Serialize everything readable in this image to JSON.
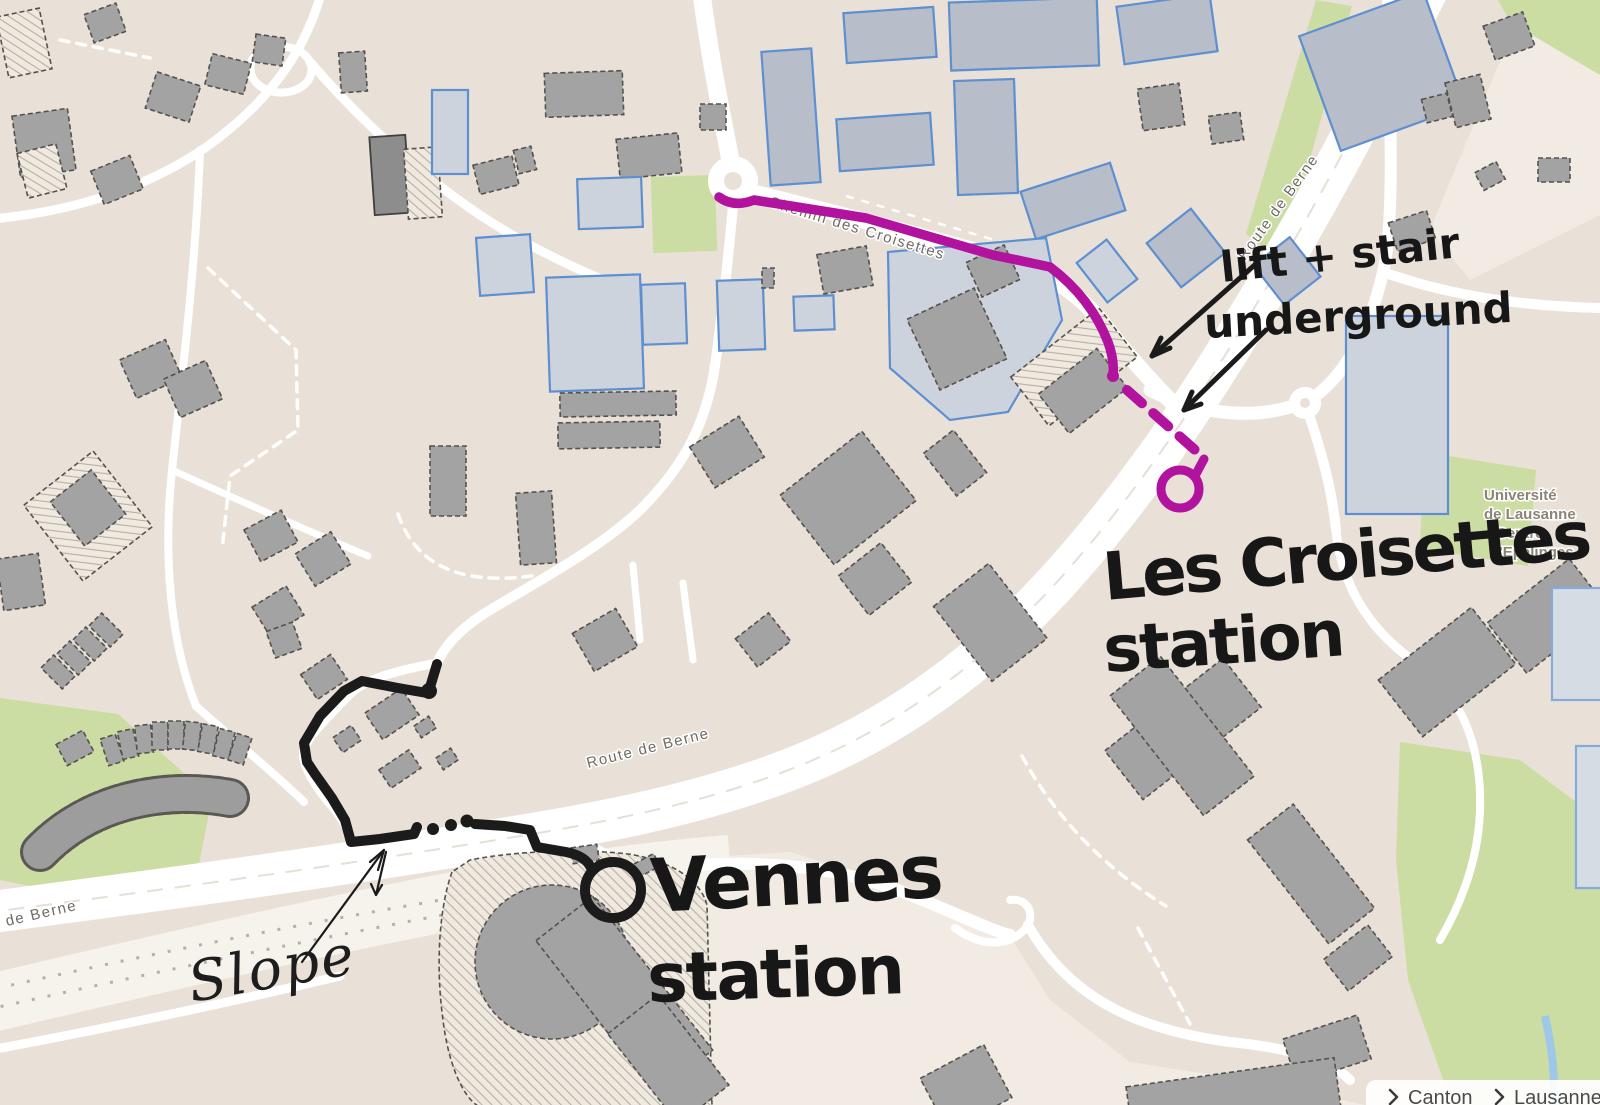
{
  "colors": {
    "route_magenta": "#b1129e",
    "route_ink": "#1b1b1b",
    "map_background": "#e9e1d7",
    "green_area": "#cbdda3",
    "building_gray": "#a3a3a3",
    "building_outline_blue": "#5d8fd1",
    "road_white": "#ffffff",
    "street_label_gray": "#6f6a63"
  },
  "street_labels": {
    "chemin_des_croisettes": "Chemin des Croisettes",
    "route_de_berne_top": "Route de Berne",
    "route_de_berne_mid": "Route de Berne",
    "route_de_berne_bottom": "Route de Berne"
  },
  "map_labels": {
    "university_line1": "Université",
    "university_line2": "de Lausanne",
    "university_line3": "Centre",
    "university_line4": "d'Epalinges"
  },
  "annotations": {
    "croisettes_station_line1": "Les Croisettes",
    "croisettes_station_line2": "station",
    "vennes_station_line1": "Vennes",
    "vennes_station_line2": "station",
    "lift_note_line1": "lift + stair",
    "lift_note_line2": "underground",
    "slope_note": "Slope"
  },
  "attribution": {
    "canton_label": "Canton",
    "lausanne_label": "Lausanne"
  },
  "icons": {
    "chevron": "chevron-right-icon"
  }
}
